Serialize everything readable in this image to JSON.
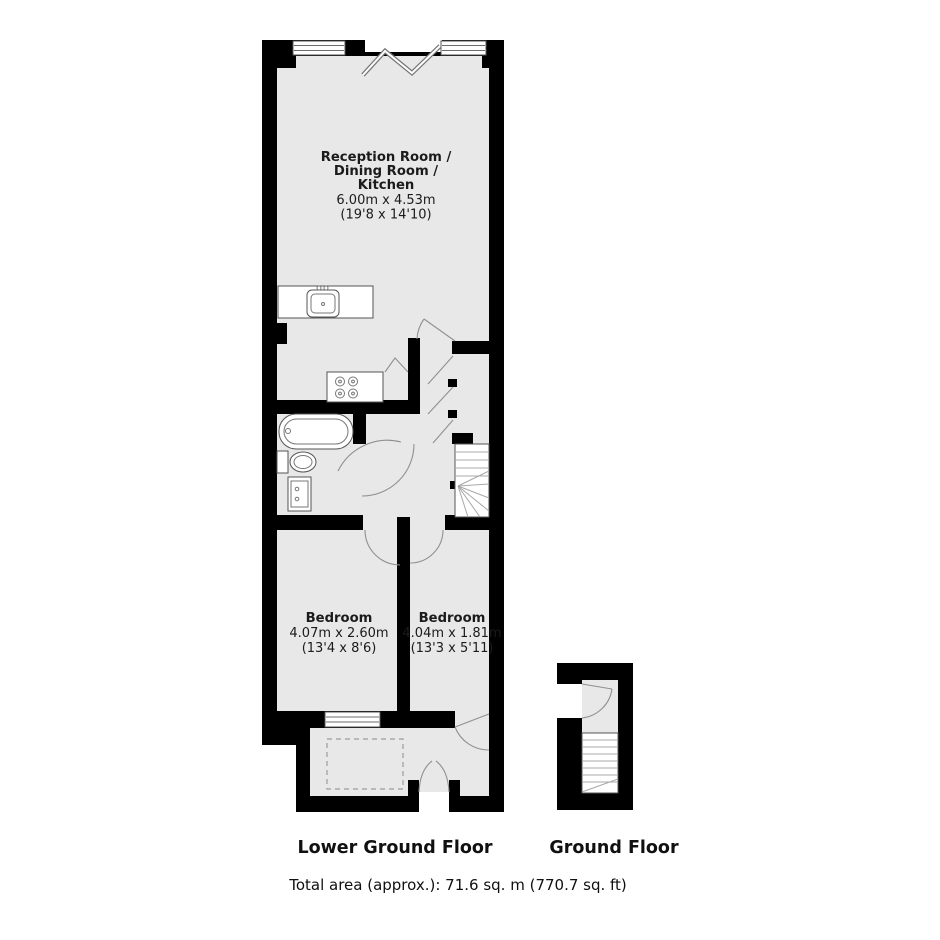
{
  "captions": {
    "lower_title": "Lower Ground Floor",
    "ground_title": "Ground Floor",
    "total_area": "Total area (approx.): 71.6  sq. m (770.7 sq. ft)"
  },
  "rooms": {
    "reception": {
      "line1": "Reception Room /",
      "line2": "Dining Room /",
      "line3": "Kitchen",
      "dims_m": "6.00m x 4.53m",
      "dims_ft": "(19'8 x 14'10)"
    },
    "bedroom_left": {
      "name": "Bedroom",
      "dims_m": "4.07m x 2.60m",
      "dims_ft": "(13'4 x 8'6)"
    },
    "bedroom_right": {
      "name": "Bedroom",
      "dims_m": "4.04m x 1.81m",
      "dims_ft": "(13'3 x 5'11)"
    }
  },
  "fixtures": [
    "kitchen-sink",
    "hob",
    "bathtub",
    "toilet",
    "washbasin",
    "staircase-lower",
    "staircase-ground",
    "bifold-doors",
    "french-doors",
    "windows",
    "wardrobe-doors",
    "patio-void"
  ],
  "colors": {
    "background": "#ffffff",
    "wall": "#000000",
    "room_fill": "#e8e8e8",
    "fixture_outline": "#555555",
    "door_swing": "#909090",
    "text": "#1b1b1b"
  }
}
